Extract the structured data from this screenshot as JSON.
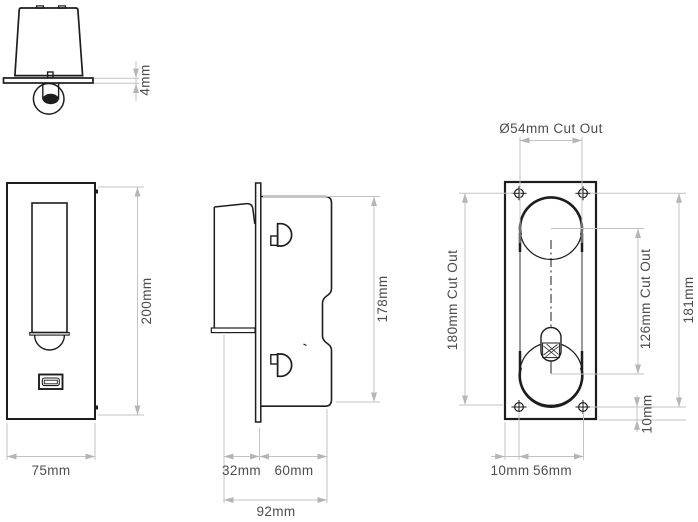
{
  "drawing_type": "dimensioned technical drawing, wall light with USB socket",
  "colors": {
    "background": "#ffffff",
    "object_line": "#1d1d1b",
    "dimension_line": "#c3c3c3",
    "label_text": "#4d4d4d"
  },
  "views": {
    "head_side_detail": {
      "title": "lamp head side detail",
      "dims": {
        "plate_protrusion": "4mm"
      }
    },
    "front_elevation": {
      "title": "front elevation",
      "dims": {
        "height": "200mm",
        "width": "75mm"
      }
    },
    "side_section": {
      "title": "side section",
      "dims": {
        "front_depth": "32mm",
        "recess_depth": "60mm",
        "total_depth": "92mm",
        "body_height": "178mm"
      }
    },
    "rear_plate": {
      "title": "rear cut-out plan",
      "dims": {
        "circle_cutout": "Ø54mm Cut Out",
        "cutout_height": "180mm Cut Out",
        "cutout_centres": "126mm Cut Out",
        "fixing_centres_vertical": "181mm",
        "fixing_edge_vertical": "10mm",
        "fixing_edge_horizontal": "10mm",
        "fixing_centres_horizontal": "56mm"
      }
    }
  }
}
